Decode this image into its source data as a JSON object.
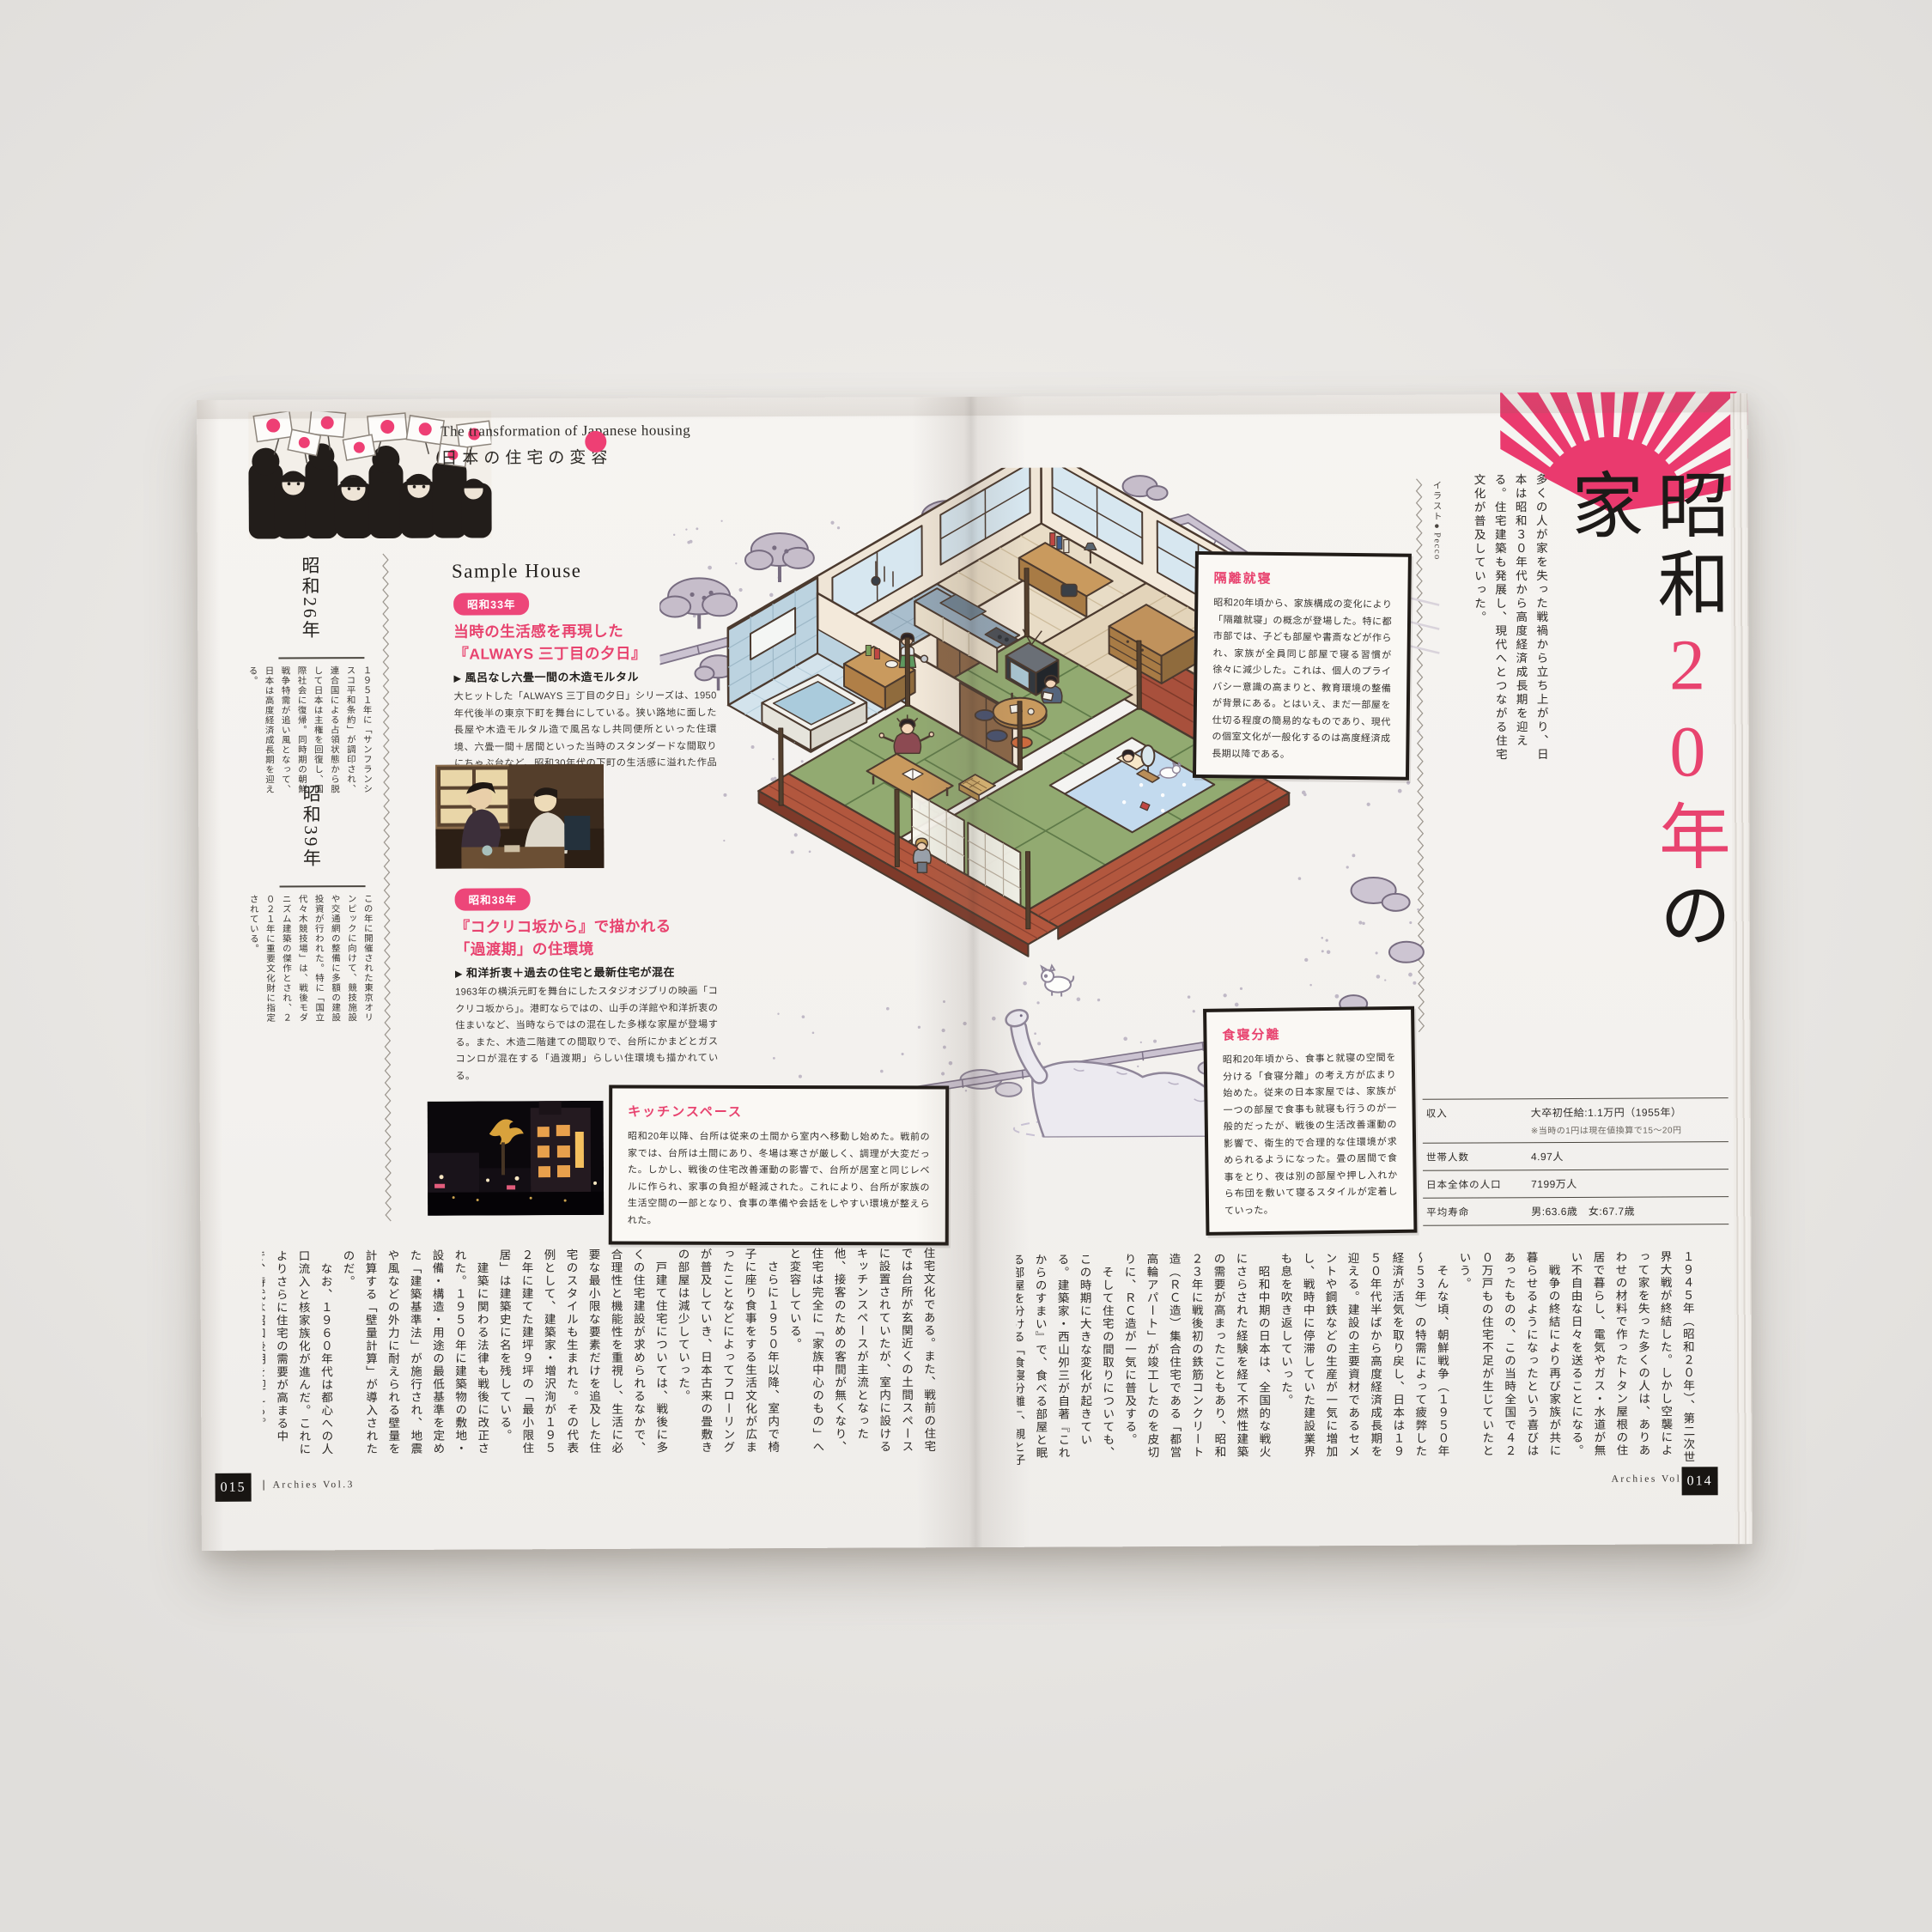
{
  "colors": {
    "accent_pink": "#e8436f",
    "fan_pink": "#ea3a6e",
    "badge_pink": "#ed4679"
  },
  "header": {
    "title_en": "The transformation of Japanese housing",
    "title_ja": "日本の住宅の変容"
  },
  "left_sidebar": {
    "era1": {
      "title": "昭和26年",
      "body": "１９５１年に「サンフランシスコ平和条約」が調印され、連合国による占領状態から脱して日本は主権を回復し、国際社会に復帰。同時期の朝鮮戦争特需が追い風となって、日本は高度経済成長期を迎える。"
    },
    "era2": {
      "title": "昭和39年",
      "body": "この年に開催された東京オリンピックに向けて、競技施設や交通網の整備に多額の建設投資が行われた。特に「国立代々木競技場」は、戦後モダニズム建築の傑作とされ、２０２１年に重要文化財に指定されている。"
    }
  },
  "sample_house": {
    "heading": "Sample House",
    "items": [
      {
        "badge": "昭和33年",
        "title_line1": "当時の生活感を再現した",
        "title_line2": "『ALWAYS 三丁目の夕日』",
        "subtitle": "風呂なし六畳一間の木造モルタル",
        "body": "大ヒットした「ALWAYS 三丁目の夕日」シリーズは、1950年代後半の東京下町を舞台にしている。狭い路地に面した長屋や木造モルタル造で風呂なし共同便所といった住環境、六畳一間＋居間といった当時のスタンダードな間取りにちゃぶ台など、昭和30年代の下町の生活感に溢れた作品となっている。"
      },
      {
        "badge": "昭和38年",
        "title_line1": "『コクリコ坂から』で描かれる",
        "title_line2": "「過渡期」の住環境",
        "subtitle": "和洋折衷＋過去の住宅と最新住宅が混在",
        "body": "1963年の横浜元町を舞台にしたスタジオジブリの映画「コクリコ坂から」。港町ならではの、山手の洋館や和洋折衷の住まいなど、当時ならではの混在した多様な家屋が登場する。また、木造二階建ての間取りで、台所にかまどとガスコンロが混在する「過渡期」らしい住環境も描かれている。"
      }
    ]
  },
  "callouts": {
    "kitchen": {
      "title": "キッチンスペース",
      "body": "昭和20年以降、台所は従来の土間から室内へ移動し始めた。戦前の家では、台所は土間にあり、冬場は寒さが厳しく、調理が大変だった。しかし、戦後の住宅改善運動の影響で、台所が居室と同じレベルに作られ、家事の負担が軽減された。これにより、台所が家族の生活空間の一部となり、食事の準備や会話をしやすい環境が整えられた。"
    },
    "kakuri": {
      "title": "隔離就寝",
      "body": "昭和20年頃から、家族構成の変化により「隔離就寝」の概念が登場した。特に都市部では、子ども部屋や書斎などが作られ、家族が全員同じ部屋で寝る習慣が徐々に減少した。これは、個人のプライバシー意識の高まりと、教育環境の整備が背景にある。とはいえ、まだ一部屋を仕切る程度の簡易的なものであり、現代の個室文化が一般化するのは高度経済成長期以降である。"
    },
    "shoku": {
      "title": "食寝分離",
      "body": "昭和20年頃から、食事と就寝の空間を分ける「食寝分離」の考え方が広まり始めた。従来の日本家屋では、家族が一つの部屋で食事も就寝も行うのが一般的だったが、戦後の生活改善運動の影響で、衛生的で合理的な住環境が求められるようになった。畳の居間で食事をとり、夜は別の部屋や押し入れから布団を敷いて寝るスタイルが定着していった。"
    }
  },
  "feature": {
    "title_black1": "昭和",
    "title_pink": "20年",
    "title_black2": "の家",
    "lede": "多くの人が家を失った戦禍から立ち上がり、日本は昭和３０年代から高度経済成長期を迎える。住宅建築も発展し、現代へとつながる住宅文化が普及していった。",
    "credit": "イラスト●Pecco"
  },
  "stats_table": {
    "rows": [
      {
        "label": "収入",
        "value": "大卒初任給:1.1万円（1955年）",
        "note": "※当時の1円は現在値換算で15～20円"
      },
      {
        "label": "世帯人数",
        "value": "4.97人",
        "note": ""
      },
      {
        "label": "日本全体の人口",
        "value": "7199万人",
        "note": ""
      },
      {
        "label": "平均寿命",
        "value": "男:63.6歳　女:67.7歳",
        "note": ""
      }
    ]
  },
  "article": {
    "right_text": "１９４５年（昭和２０年）、第二次世界大戦が終結した。しかし空襲によって家を失った多くの人は、ありあわせの材料で作ったトタン屋根の住居で暮らし、電気やガス・水道が無い不自由な日々を送ることになる。\n　戦争の終結により再び家族が共に暮らせるようになったという喜びはあったものの、この当時全国で４２０万戸もの住宅不足が生じていたという。\n　そんな頃、朝鮮戦争（１９５０年～５３年）の特需によって疲弊した経済が活気を取り戻し、日本は１９５０年代半ばから高度経済成長期を迎える。建設の主要資材であるセメントや鋼鉄などの生産が一気に増加し、戦時中に停滞していた建設業界も息を吹き返していった。\n　昭和中期の日本は、全国的な戦火にさらされた経験を経て不燃性建築の需要が高まったこともあり、昭和２３年に戦後初の鉄筋コンクリート造（ＲＣ造）集合住宅である「都営高輪アパート」が竣工したのを皮切りに、ＲＣ造が一気に普及する。\n　そして住宅の間取りについても、この時期に大きな変化が起きている。建築家・西山夘三が自著『これからのすまい』で、食べる部屋と眠る部屋を分ける「食寝分離」、親と子の就寝空間を分ける「隔離就寝」などを提唱。\n　これらの概念は現代にも通じる日本の",
    "left_text": "住宅文化である。また、戦前の住宅では台所が玄関近くの土間スペースに設置されていたが、室内に設けるキッチンスペースが主流となった他、接客のための客間が無くなり、住宅は完全に「家族中心のもの」へと変容している。\n　さらに１９５０年以降、室内で椅子に座り食事をする生活文化が広まったことなどによってフローリングが普及していき、日本古来の畳敷きの部屋は減少していった。\n　戸建て住宅については、戦後に多くの住宅建設が求められるなかで、合理性と機能性を重視し、生活に必要な最小限な要素だけを追及した住宅のスタイルも生まれた。その代表例として、建築家・増沢洵が１９５２年に建てた建坪９坪の「最小限住居」は建築史に名を残している。\n　建築に関わる法律も戦後に改正された。１９５０年に建築物の敷地・設備・構造・用途の最低基準を定めた「建築基準法」が施行され、地震や風などの外力に耐えられる壁量を計算する「壁量計算」が導入されたのだ。\n　なお、１９６０年代は都心への人口流入と核家族化が進んだ。これによりさらに住宅の需要が高まる中で、時代は昭和後期を迎える。"
  },
  "footer": {
    "left_page_num": "015",
    "right_page_num": "014",
    "brand": "Archies Vol.3"
  }
}
